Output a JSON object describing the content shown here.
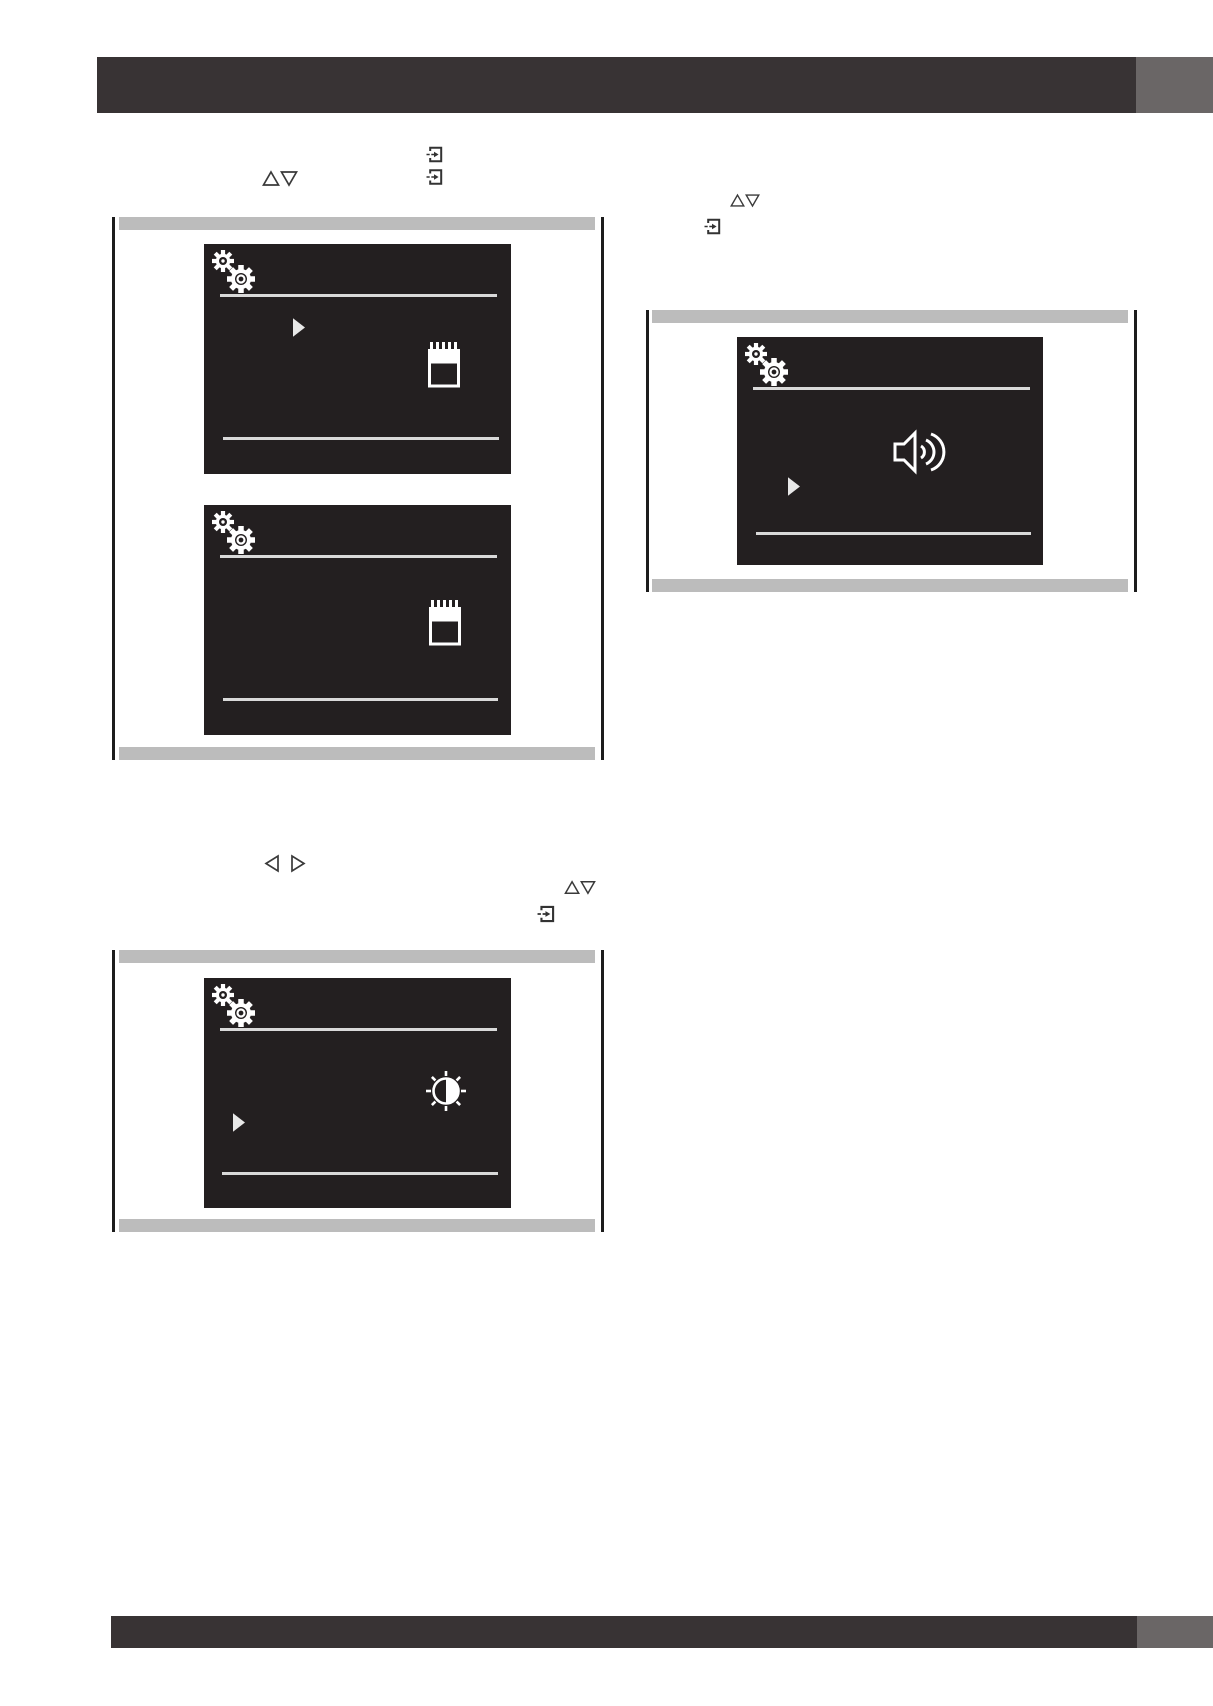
{
  "page": {
    "kind": "manual-illustration-page",
    "visible_text": "",
    "language_note": "page shows only illustrations and rules; no readable text is printed"
  },
  "colors": {
    "header_bar": "#383334",
    "corner_block": "#6a6666",
    "figure_bar": "#bcbcbc",
    "figure_border": "#1c1c1c",
    "panel_bg": "#231f20",
    "panel_fg": "#ffffff",
    "panel_line": "#d9d9d9",
    "cursor": "#e8e8e8",
    "icon_outline": "#3a3a3a",
    "page_bg": "#ffffff"
  },
  "header": {
    "style": "dark-rule-bar-with-gray-corner-block"
  },
  "footer": {
    "style": "dark-rule-bar-with-gray-corner-block"
  },
  "inline_key_icons": {
    "top_left_column": [
      "enter-key-icon",
      "enter-key-icon",
      "up-down-arrows-icon"
    ],
    "top_right_column": [
      "up-down-arrows-icon",
      "enter-key-icon"
    ],
    "middle_left_column": [
      "left-right-arrows-icon",
      "up-down-arrows-icon",
      "enter-key-icon"
    ]
  },
  "figures": [
    {
      "name": "figure-settings-date",
      "caption_bars": 2,
      "screens": [
        {
          "name": "screen-settings-menu-with-cursor",
          "icons": [
            "settings-gears-icon",
            "menu-cursor-icon",
            "calendar-icon"
          ],
          "rules": 2
        },
        {
          "name": "screen-settings-menu",
          "icons": [
            "settings-gears-icon",
            "calendar-icon"
          ],
          "rules": 2
        }
      ]
    },
    {
      "name": "figure-settings-sound",
      "caption_bars": 2,
      "screens": [
        {
          "name": "screen-settings-sound",
          "icons": [
            "settings-gears-icon",
            "menu-cursor-icon",
            "speaker-icon"
          ],
          "rules": 2
        }
      ]
    },
    {
      "name": "figure-settings-brightness",
      "caption_bars": 2,
      "screens": [
        {
          "name": "screen-settings-brightness",
          "icons": [
            "settings-gears-icon",
            "menu-cursor-icon",
            "brightness-icon"
          ],
          "rules": 2
        }
      ]
    }
  ]
}
